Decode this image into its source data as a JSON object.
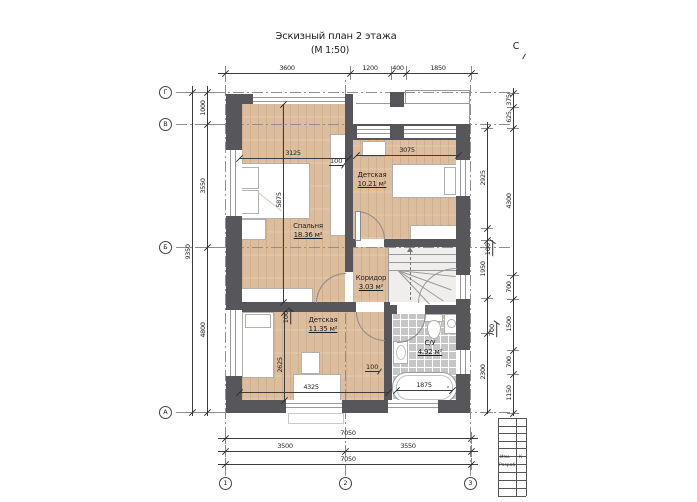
{
  "title": {
    "line1": "Эскизный план 2 этажа",
    "line2": "(М 1:50)"
  },
  "north_label": "С",
  "colors": {
    "wall": "#57575b",
    "wood_floor": "#dcbd9e",
    "tile_floor": "#c6c6c6",
    "dim_line": "#3c3c3c"
  },
  "rooms": [
    {
      "name": "Спальня",
      "area": "18.36 м²",
      "x": 308,
      "y": 227
    },
    {
      "name": "Детская",
      "area": "10.21 м²",
      "x": 372,
      "y": 176
    },
    {
      "name": "Коридор",
      "area": "3.03 м²",
      "x": 371,
      "y": 279
    },
    {
      "name": "Детская",
      "area": "11.35 м²",
      "x": 323,
      "y": 321
    },
    {
      "name": "С/У",
      "area": "4.92 м²",
      "x": 430,
      "y": 344
    }
  ],
  "grid_axes": {
    "rows": [
      {
        "label": "Г",
        "y": 92
      },
      {
        "label": "В",
        "y": 124
      },
      {
        "label": "Б",
        "y": 247
      },
      {
        "label": "А",
        "y": 412
      }
    ],
    "row_bubble_x": 165,
    "row_line_x1": 176,
    "row_line_x2": 512,
    "cols": [
      {
        "label": "1",
        "x": 225
      },
      {
        "label": "2",
        "x": 345
      },
      {
        "label": "3",
        "x": 470
      }
    ],
    "col_bubble_y": 483,
    "col_line_y1": 80,
    "col_line_y2": 476
  },
  "dimensions": {
    "chains": [
      {
        "name": "top",
        "o": "h",
        "pos": 73,
        "from": 218,
        "to": 478,
        "ticks": [
          225,
          350,
          391,
          406,
          471
        ],
        "ext": 14,
        "labels": [
          {
            "t": "3600",
            "p": 287
          },
          {
            "t": "1200",
            "p": 370
          },
          {
            "t": "400",
            "p": 398
          },
          {
            "t": "1850",
            "p": 438
          }
        ]
      },
      {
        "name": "left-outer",
        "o": "v",
        "pos": 192,
        "from": 86,
        "to": 416,
        "ticks": [
          92,
          412
        ],
        "ext": 14,
        "labels": [
          {
            "t": "9350",
            "p": 252
          }
        ]
      },
      {
        "name": "left-inner",
        "o": "v",
        "pos": 207,
        "from": 86,
        "to": 416,
        "ticks": [
          92,
          124,
          247,
          412
        ],
        "ext": 14,
        "labels": [
          {
            "t": "1000",
            "p": 108
          },
          {
            "t": "3550",
            "p": 186
          },
          {
            "t": "4800",
            "p": 330
          }
        ]
      },
      {
        "name": "right-inner",
        "o": "v",
        "pos": 487,
        "from": 122,
        "to": 414,
        "ticks": [
          128,
          228,
          240,
          298,
          333,
          412
        ],
        "ext": 12,
        "labels": [
          {
            "t": "2925",
            "p": 178
          },
          {
            "t": "1950",
            "p": 269
          },
          {
            "t": "2300",
            "p": 372
          }
        ]
      },
      {
        "name": "right-outer",
        "o": "v",
        "pos": 513,
        "from": 88,
        "to": 416,
        "ticks": [
          93,
          107,
          128,
          275,
          299,
          350,
          374,
          413
        ],
        "ext": 12,
        "labels": [
          {
            "t": "375",
            "p": 100
          },
          {
            "t": "625",
            "p": 117
          },
          {
            "t": "4300",
            "p": 201
          },
          {
            "t": "700",
            "p": 287
          },
          {
            "t": "1500",
            "p": 324
          },
          {
            "t": "700",
            "p": 362
          },
          {
            "t": "1150",
            "p": 393
          }
        ]
      },
      {
        "name": "bottom-a",
        "o": "h",
        "pos": 438,
        "from": 218,
        "to": 478,
        "ticks": [
          225,
          471
        ],
        "ext": 12,
        "labels": [
          {
            "t": "7050",
            "p": 348
          }
        ]
      },
      {
        "name": "bottom-b",
        "o": "h",
        "pos": 451,
        "from": 218,
        "to": 478,
        "ticks": [
          225,
          345,
          471
        ],
        "ext": 12,
        "labels": [
          {
            "t": "3500",
            "p": 285
          },
          {
            "t": "3550",
            "p": 408
          }
        ]
      },
      {
        "name": "bottom-c",
        "o": "h",
        "pos": 464,
        "from": 218,
        "to": 478,
        "ticks": [
          225,
          471
        ],
        "ext": 12,
        "labels": [
          {
            "t": "7050",
            "p": 348
          }
        ]
      },
      {
        "name": "room-3125",
        "o": "h",
        "pos": 158,
        "from": 239,
        "to": 348,
        "ticks": [
          239,
          348
        ],
        "ext": 0,
        "labels": [
          {
            "t": "3125",
            "p": 293
          }
        ]
      },
      {
        "name": "room-3075",
        "o": "h",
        "pos": 155,
        "from": 356,
        "to": 458,
        "ticks": [
          356,
          458
        ],
        "ext": 0,
        "labels": [
          {
            "t": "3075",
            "p": 407
          }
        ]
      },
      {
        "name": "room-5875",
        "o": "v",
        "pos": 283,
        "from": 104,
        "to": 302,
        "ticks": [
          104,
          302
        ],
        "ext": 0,
        "labels": [
          {
            "t": "5875",
            "p": 200
          }
        ]
      },
      {
        "name": "room-2625",
        "o": "v",
        "pos": 284,
        "from": 312,
        "to": 400,
        "ticks": [
          312,
          400
        ],
        "ext": 0,
        "labels": [
          {
            "t": "2625",
            "p": 365
          }
        ]
      },
      {
        "name": "room-4325",
        "o": "h",
        "pos": 392,
        "from": 239,
        "to": 388,
        "ticks": [
          239,
          388
        ],
        "ext": 0,
        "labels": [
          {
            "t": "4325",
            "p": 311
          }
        ]
      },
      {
        "name": "tub-1875",
        "o": "h",
        "pos": 390,
        "from": 396,
        "to": 452,
        "ticks": [
          396,
          452
        ],
        "ext": 0,
        "labels": [
          {
            "t": "1875",
            "p": 424
          }
        ]
      }
    ],
    "leaders": [
      {
        "t": "100",
        "x": 338,
        "y": 161,
        "rot": 0
      },
      {
        "t": "100",
        "x": 288,
        "y": 317,
        "rot": -90
      },
      {
        "t": "100",
        "x": 374,
        "y": 367,
        "rot": 0
      },
      {
        "t": "100",
        "x": 490,
        "y": 249,
        "rot": -90
      },
      {
        "t": "700",
        "x": 494,
        "y": 330,
        "rot": -90
      }
    ]
  },
  "titleblock": {
    "col_xs": [
      498,
      516,
      526
    ],
    "row_ys": [
      418,
      426,
      433,
      441,
      448,
      456,
      464,
      472,
      480,
      488,
      496
    ],
    "x1": 498,
    "x2": 526,
    "y1": 418,
    "y2": 496,
    "labels": [
      {
        "t": "Изм.",
        "x": 500,
        "y": 458
      },
      {
        "t": "К",
        "x": 519,
        "y": 458
      },
      {
        "t": "Разраб.",
        "x": 499,
        "y": 466
      }
    ]
  }
}
